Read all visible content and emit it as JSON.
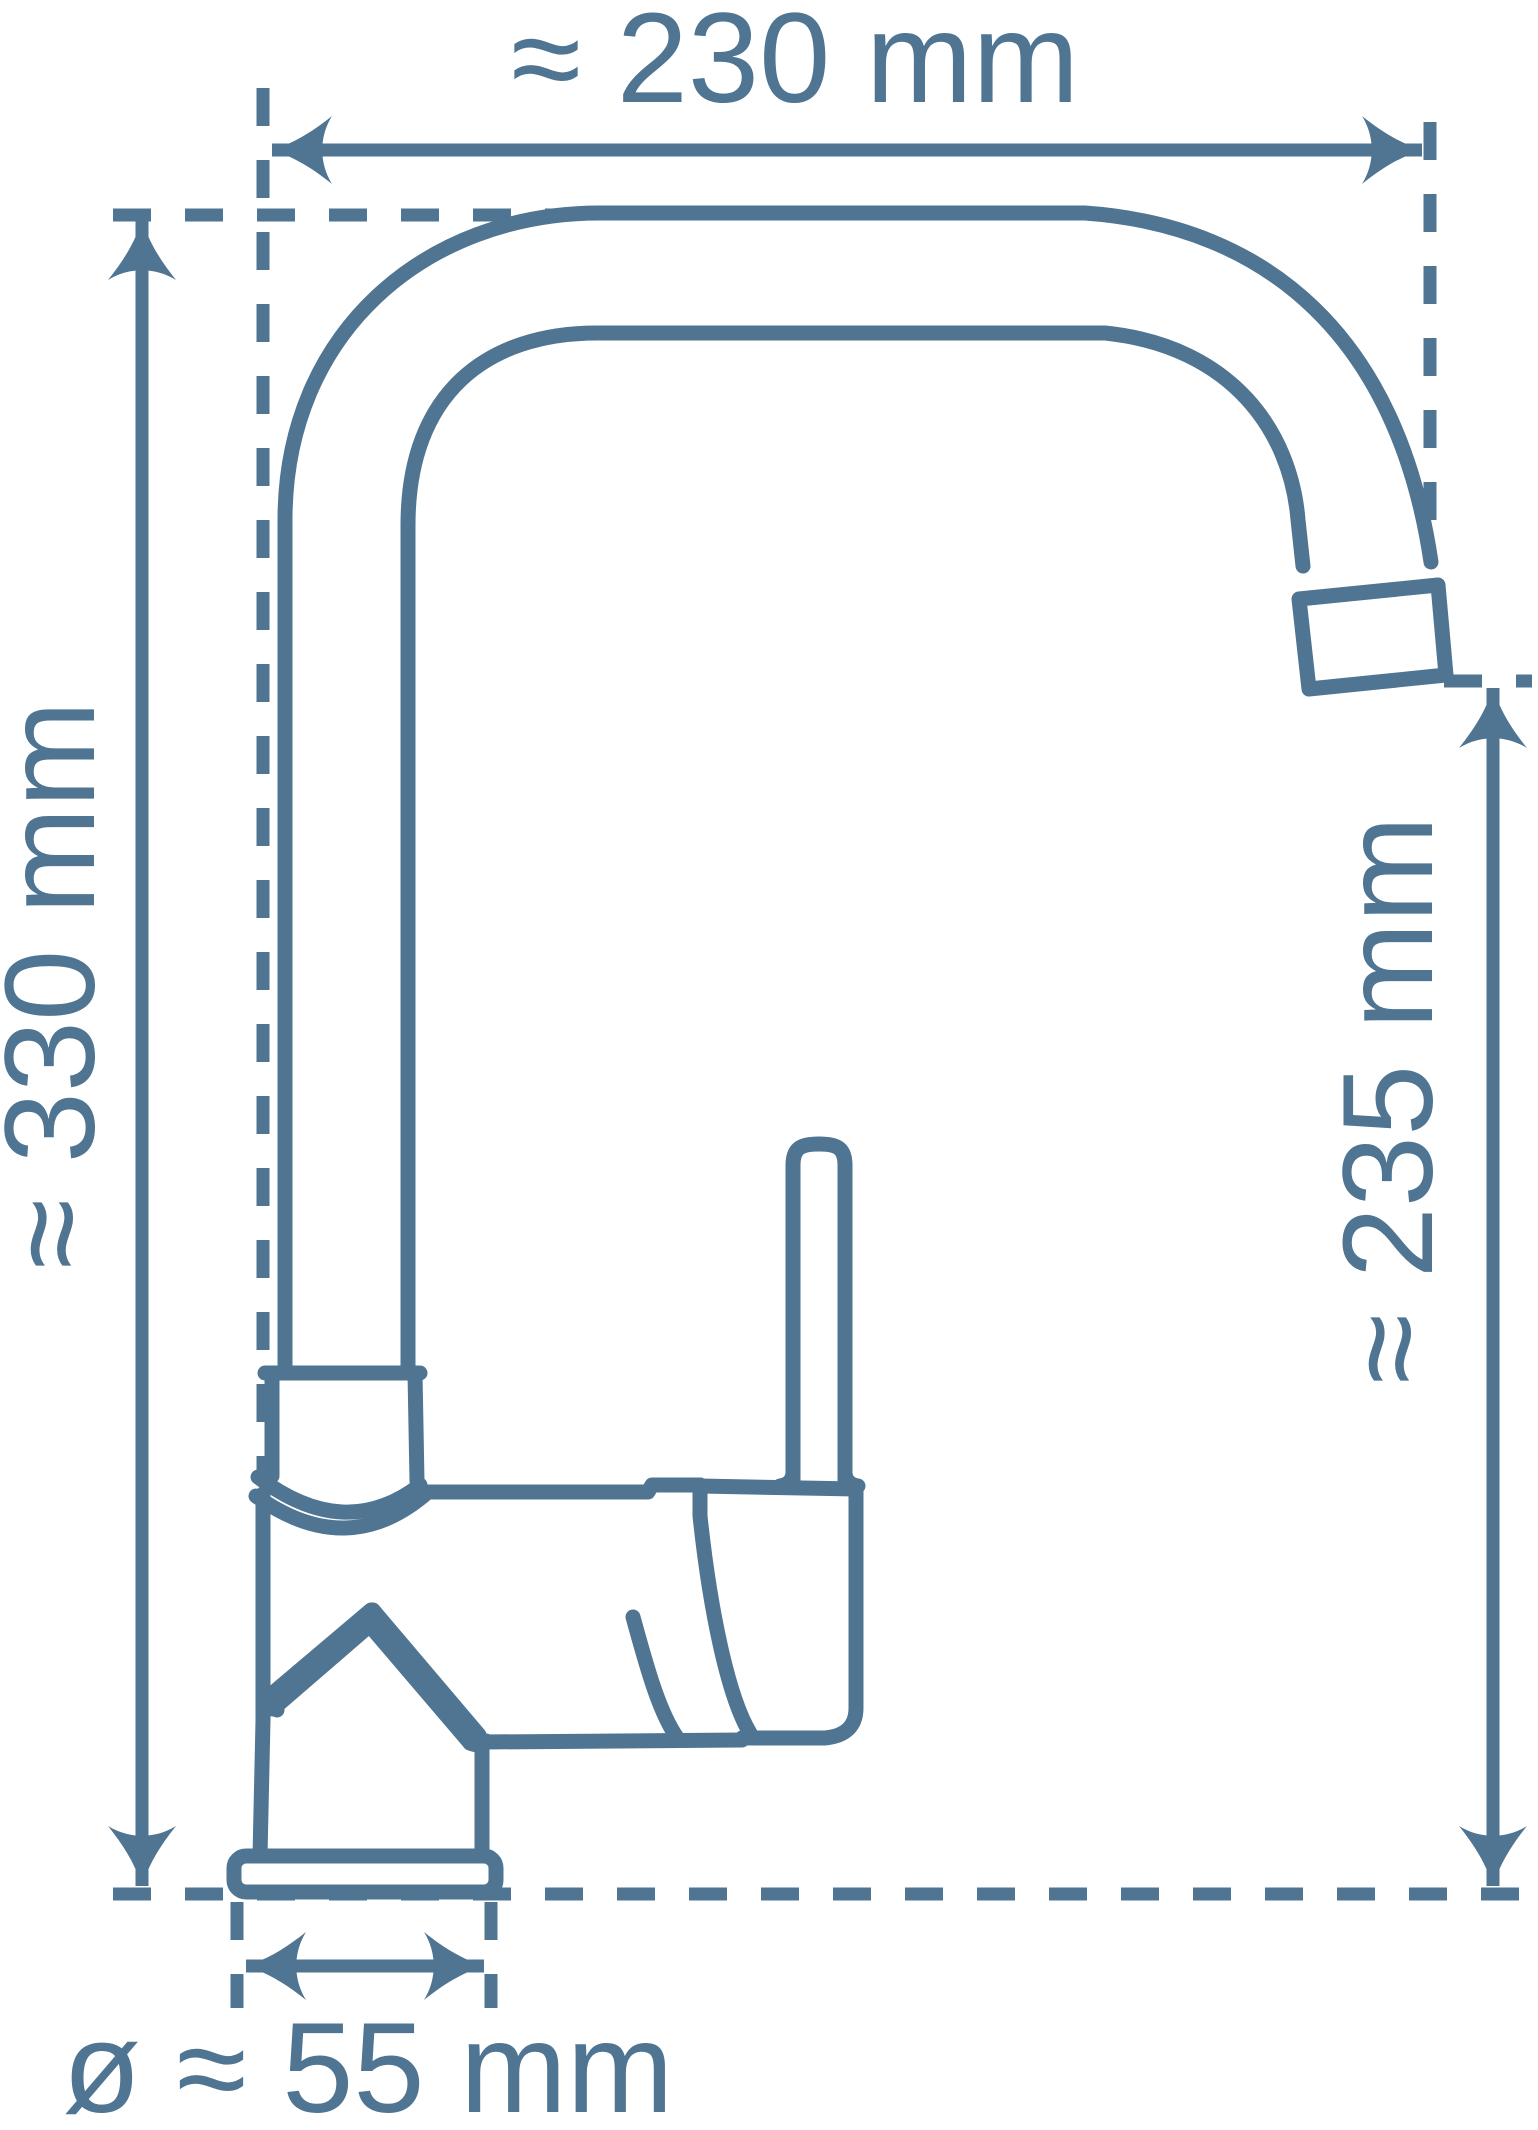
{
  "drawing": {
    "type": "technical-dimension-diagram",
    "line_color": "#4f7592",
    "background_color": "#ffffff",
    "dimensions": {
      "width": {
        "label": "≈ 230 mm"
      },
      "total_height": {
        "label": "≈ 330 mm"
      },
      "spout_height": {
        "label": "≈ 235 mm"
      },
      "base_diameter": {
        "label": "ø ≈ 55 mm"
      }
    }
  }
}
